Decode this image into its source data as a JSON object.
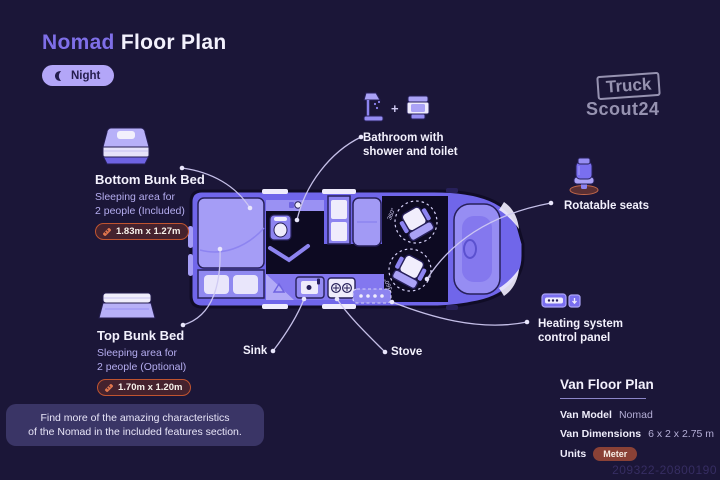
{
  "header": {
    "title_accent": "Nomad",
    "title_rest": "Floor Plan",
    "mode": {
      "label": "Night",
      "icon": "moon-icon"
    }
  },
  "logo": {
    "top": "Truck",
    "bottom": "Scout24"
  },
  "callouts": {
    "bathroom": {
      "line1": "Bathroom with",
      "line2": "shower and toilet",
      "plus": "+"
    },
    "bottom_bunk": {
      "title": "Bottom Bunk Bed",
      "desc1": "Sleeping area for",
      "desc2": "2 people (Included)",
      "dimensions": "1.83m x 1.27m"
    },
    "top_bunk": {
      "title": "Top Bunk Bed",
      "desc1": "Sleeping area for",
      "desc2": "2 people (Optional)",
      "dimensions": "1.70m x 1.20m"
    },
    "rotatable_seats": {
      "label": "Rotatable seats"
    },
    "heating": {
      "line1": "Heating system",
      "line2": "control panel"
    },
    "sink": {
      "label": "Sink"
    },
    "stove": {
      "label": "Stove"
    }
  },
  "plan": {
    "seat_rotation": "360°"
  },
  "note": {
    "line1": "Find more of the amazing characteristics",
    "line2": "of the Nomad in the included features section."
  },
  "info_panel": {
    "title": "Van Floor Plan",
    "rows": [
      {
        "label": "Van Model",
        "value": "Nomad"
      },
      {
        "label": "Van Dimensions",
        "value": "6 x 2 x 2.75 m"
      }
    ],
    "units_label": "Units",
    "units_badge": "Meter"
  },
  "footer": {
    "id_number": "209322-20800190"
  },
  "colors": {
    "background": "#1b1638",
    "accent_purple": "#7f6fe8",
    "pill_bg": "#b3a6f8",
    "van_body": "#7066ea",
    "van_light": "#a59df6",
    "dark_room": "#0d0a22",
    "badge_border": "#c05430",
    "badge_bg": "#45222e",
    "meter_badge_bg": "#8a4136",
    "leader_line": "#cfc9f2"
  }
}
